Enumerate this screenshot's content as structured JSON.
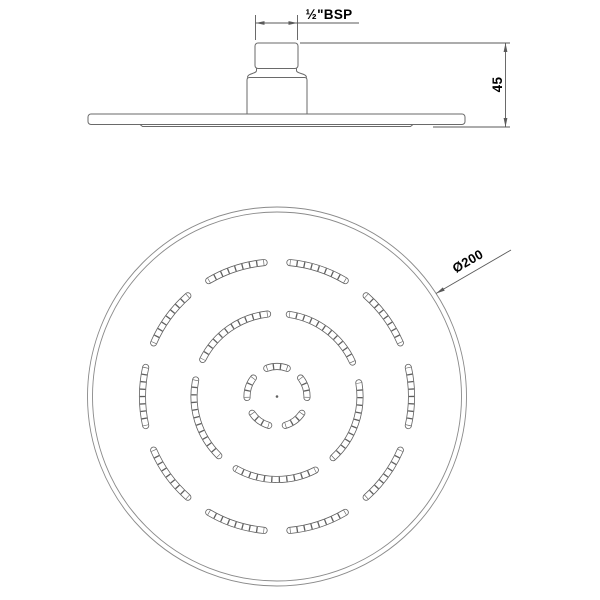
{
  "drawing": {
    "type": "technical-drawing",
    "subject": "overhead shower head, side elevation and face view",
    "labels": {
      "thread_size": "½\"BSP",
      "height_mm": "45",
      "diameter": "Ø200"
    },
    "colors": {
      "line": "#6a6a6a",
      "rim": "#8a8a8a",
      "slot": "#606060",
      "dim": "#5a5a5a",
      "text": "#3a3a3a",
      "background": "#ffffff"
    },
    "side_view": {
      "plate": {
        "x": 88,
        "y": 114,
        "w": 377,
        "h": 10.5,
        "rx": 3
      },
      "lip": {
        "x1": 140,
        "x2": 413,
        "y": 126.5
      },
      "stem_base": {
        "x": 247,
        "y": 77.5,
        "w": 60,
        "bottom": 114.5,
        "rx": 2.5
      },
      "stem_top": {
        "x": 255,
        "y": 43,
        "w": 43,
        "h": 25.5,
        "rx": 3
      },
      "thread_dim": {
        "xl": 255.5,
        "xr": 297.5,
        "line_y": 23,
        "ext_y1": 15,
        "ext_y2": 40,
        "shelf_x2": 359
      },
      "height_dim": {
        "x": 505.5,
        "y1": 43,
        "y2": 127,
        "top_ext_x1": 300,
        "bot_ext_x1": 433,
        "ext_x2": 510
      }
    },
    "face_view": {
      "center": {
        "x": 277,
        "y": 396.5
      },
      "outer_radius": 189.5,
      "inner_radius": 184.5,
      "center_dot_radius": 1.3,
      "dia_leader": {
        "tip_x": 436,
        "tip_y": 293.5,
        "end_x": 511,
        "end_y": 250
      },
      "slot_outer_width": 7,
      "slot_inner_width": 5.4,
      "nozzle_rings": [
        {
          "radius": 30,
          "arc_span_deg": 40,
          "arc_centers_deg": [
            18,
            90,
            162,
            234,
            306
          ],
          "cells_per_arc": 3
        },
        {
          "radius": 83,
          "arc_span_deg": 57,
          "arc_centers_deg": [
            53,
            125,
            197,
            269,
            341
          ],
          "cells_per_arc": 11
        },
        {
          "radius": 134.5,
          "arc_span_deg": 25,
          "arc_centers_deg": [
            0,
            36,
            72,
            108,
            144,
            180,
            216,
            252,
            288,
            324
          ],
          "cells_per_arc": 8
        }
      ]
    }
  }
}
